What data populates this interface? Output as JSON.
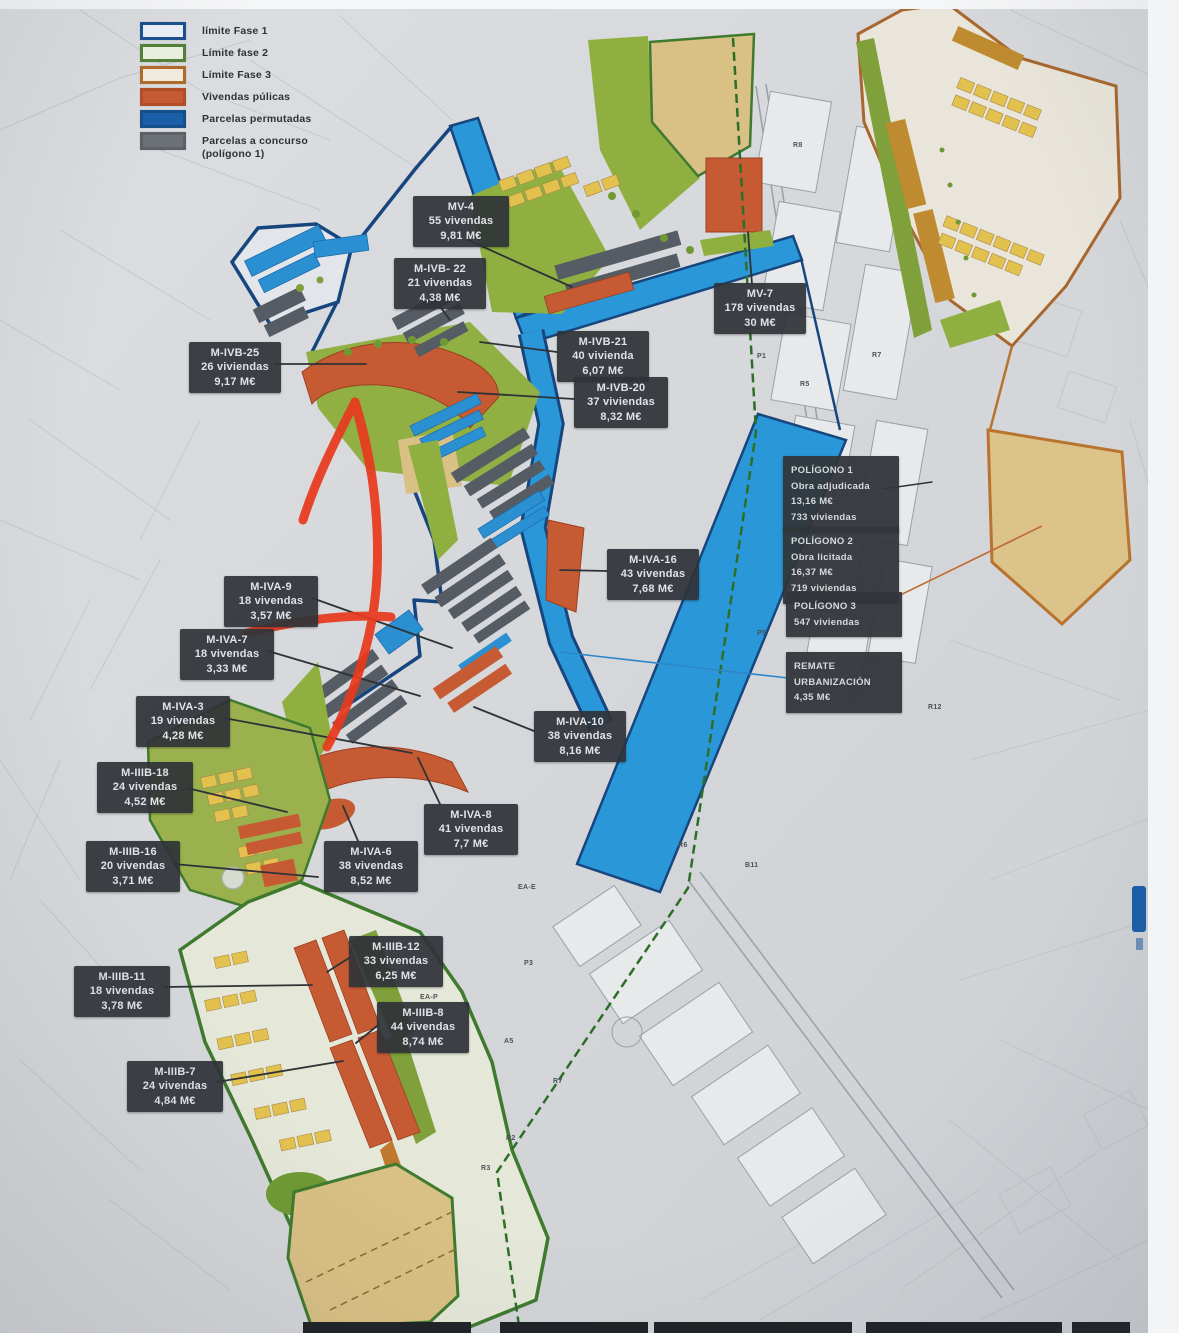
{
  "legend": {
    "items": [
      {
        "label": "límite Fase 1",
        "swatch_fill": "#e7ecf2",
        "swatch_border": "#1d4e8f"
      },
      {
        "label": "Límite fase 2",
        "swatch_fill": "#e9efdc",
        "swatch_border": "#55803a"
      },
      {
        "label": "Límite Fase 3",
        "swatch_fill": "#f0e9de",
        "swatch_border": "#b06a2a"
      },
      {
        "label": "Vivendas púlicas",
        "swatch_fill": "#c65b33",
        "swatch_border": "#b04e28"
      },
      {
        "label": "Parcelas permutadas",
        "swatch_fill": "#1a5fa8",
        "swatch_border": "#174f8c"
      },
      {
        "label": "Parcelas a concurso (polígono 1)",
        "swatch_fill": "#6b7177",
        "swatch_border": "#5c6167"
      }
    ]
  },
  "parcel_labels": [
    {
      "id": "mv-4",
      "x": 413,
      "y": 196,
      "w": 90,
      "lines": [
        "MV-4",
        "55 vivendas",
        "9,81 M€"
      ]
    },
    {
      "id": "m-ivb-22",
      "x": 394,
      "y": 258,
      "w": 86,
      "lines": [
        "M-IVB- 22",
        "21 vivendas",
        "4,38 M€"
      ]
    },
    {
      "id": "mv-7",
      "x": 714,
      "y": 283,
      "w": 86,
      "lines": [
        "MV-7",
        "178 vivendas",
        "30 M€"
      ]
    },
    {
      "id": "m-ivb-21",
      "x": 557,
      "y": 331,
      "w": 86,
      "lines": [
        "M-IVB-21",
        "40 vivienda",
        "6,07 M€"
      ]
    },
    {
      "id": "m-ivb-20",
      "x": 574,
      "y": 377,
      "w": 88,
      "lines": [
        "M-IVB-20",
        "37 viviendas",
        "8,32 M€"
      ]
    },
    {
      "id": "m-ivb-25",
      "x": 189,
      "y": 342,
      "w": 86,
      "lines": [
        "M-IVB-25",
        "26 viviendas",
        "9,17 M€"
      ]
    },
    {
      "id": "m-iva-16",
      "x": 607,
      "y": 549,
      "w": 86,
      "lines": [
        "M-IVA-16",
        "43 vivendas",
        "7,68 M€"
      ]
    },
    {
      "id": "m-iva-9",
      "x": 224,
      "y": 576,
      "w": 88,
      "lines": [
        "M-IVA-9",
        "18 vivendas",
        "3,57 M€"
      ]
    },
    {
      "id": "m-iva-7",
      "x": 180,
      "y": 629,
      "w": 88,
      "lines": [
        "M-IVA-7",
        "18 vivendas",
        "3,33 M€"
      ]
    },
    {
      "id": "m-iva-3",
      "x": 136,
      "y": 696,
      "w": 88,
      "lines": [
        "M-IVA-3",
        "19 vivendas",
        "4,28 M€"
      ]
    },
    {
      "id": "m-iiib-18",
      "x": 97,
      "y": 762,
      "w": 90,
      "lines": [
        "M-IIIB-18",
        "24 vivendas",
        "4,52 M€"
      ]
    },
    {
      "id": "m-iiib-16",
      "x": 86,
      "y": 841,
      "w": 88,
      "lines": [
        "M-IIIB-16",
        "20 vivendas",
        "3,71 M€"
      ]
    },
    {
      "id": "m-iva-10",
      "x": 534,
      "y": 711,
      "w": 86,
      "lines": [
        "M-IVA-10",
        "38 vivendas",
        "8,16 M€"
      ]
    },
    {
      "id": "m-iva-8",
      "x": 424,
      "y": 804,
      "w": 88,
      "lines": [
        "M-IVA-8",
        "41 vivendas",
        "7,7 M€"
      ]
    },
    {
      "id": "m-iva-6",
      "x": 324,
      "y": 841,
      "w": 88,
      "lines": [
        "M-IVA-6",
        "38 vivendas",
        "8,52 M€"
      ]
    },
    {
      "id": "m-iiib-12",
      "x": 349,
      "y": 936,
      "w": 88,
      "lines": [
        "M-IIIB-12",
        "33 vivendas",
        "6,25 M€"
      ]
    },
    {
      "id": "m-iiib-11",
      "x": 74,
      "y": 966,
      "w": 90,
      "lines": [
        "M-IIIB-11",
        "18 vivendas",
        "3,78 M€"
      ]
    },
    {
      "id": "m-iiib-8",
      "x": 377,
      "y": 1002,
      "w": 86,
      "lines": [
        "M-IIIB-8",
        "44 vivendas",
        "8,74 M€"
      ]
    },
    {
      "id": "m-iiib-7",
      "x": 127,
      "y": 1061,
      "w": 90,
      "lines": [
        "M-IIIB-7",
        "24 vivendas",
        "4,84 M€"
      ]
    }
  ],
  "info_boxes": [
    {
      "id": "poligono-1",
      "x": 783,
      "y": 456,
      "w": 100,
      "lines": [
        "POLÍGONO 1",
        "Obra adjudicada",
        "13,16 M€",
        "733 viviendas"
      ]
    },
    {
      "id": "poligono-2",
      "x": 783,
      "y": 527,
      "w": 100,
      "lines": [
        "POLÍGONO 2",
        "Obra licitada",
        "16,37 M€",
        "719 viviendas"
      ]
    },
    {
      "id": "poligono-3",
      "x": 786,
      "y": 592,
      "w": 100,
      "lines": [
        "POLÍGONO 3",
        "547 viviendas"
      ]
    },
    {
      "id": "remate",
      "x": 786,
      "y": 652,
      "w": 100,
      "lines": [
        "REMATE",
        "URBANIZACIÓN",
        "4,35 M€"
      ]
    }
  ],
  "map_codes": [
    {
      "t": "E.L.",
      "x": 744,
      "y": 324
    },
    {
      "t": "P1",
      "x": 757,
      "y": 353
    },
    {
      "t": "R5",
      "x": 800,
      "y": 381
    },
    {
      "t": "R7",
      "x": 872,
      "y": 352
    },
    {
      "t": "R8",
      "x": 793,
      "y": 142
    },
    {
      "t": "P5",
      "x": 757,
      "y": 630
    },
    {
      "t": "R12",
      "x": 928,
      "y": 704
    },
    {
      "t": "B11",
      "x": 745,
      "y": 862
    },
    {
      "t": "R6",
      "x": 678,
      "y": 842
    },
    {
      "t": "EA-E",
      "x": 518,
      "y": 884
    },
    {
      "t": "P3",
      "x": 524,
      "y": 960
    },
    {
      "t": "EA-P",
      "x": 420,
      "y": 994
    },
    {
      "t": "A5",
      "x": 504,
      "y": 1038
    },
    {
      "t": "R7",
      "x": 553,
      "y": 1078
    },
    {
      "t": "R2",
      "x": 506,
      "y": 1135
    },
    {
      "t": "R3",
      "x": 481,
      "y": 1165
    }
  ],
  "annotation": {
    "name": "hand-drawn red arrow",
    "color": "#e8391d"
  }
}
